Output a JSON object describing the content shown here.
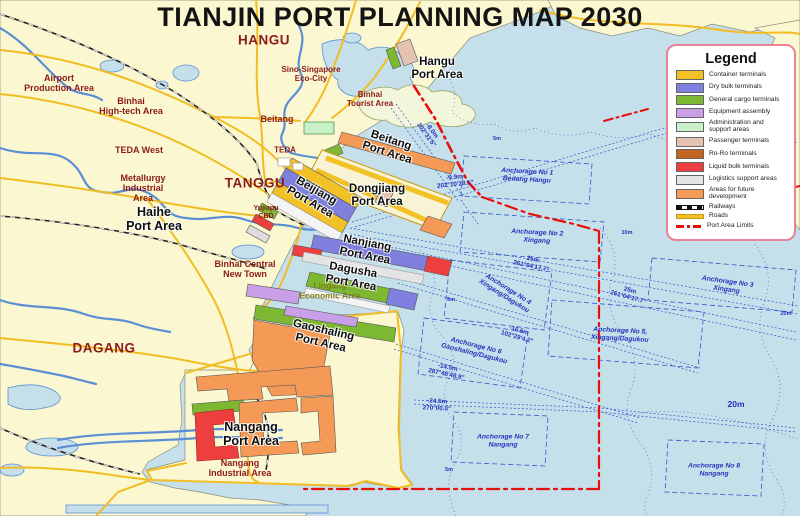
{
  "title": "TIANJIN PORT PLANNING MAP 2030",
  "colors": {
    "sea": "#c5dfeb",
    "land": "#fbf7d0",
    "road": "#f2bd24",
    "river": "#5b8fd4",
    "railway": "#222222",
    "port_limit": "#e8100a",
    "place_label": "#8b1b1b",
    "sea_label": "#2233bb",
    "container": "#f2c125",
    "dry_bulk": "#7f7fdd",
    "general_cargo": "#7cb832",
    "equipment": "#c9a0e8",
    "admin": "#c9f0c9",
    "passenger": "#e5c3b2",
    "roro": "#c3641f",
    "liquid": "#ee3f3f",
    "logistics": "#e4e4e4",
    "future": "#f59a56"
  },
  "legend": {
    "title": "Legend",
    "items": [
      {
        "key": "container",
        "label": "Container terminals",
        "type": "swatch",
        "color": "#f2c125"
      },
      {
        "key": "dry-bulk",
        "label": "Dry bulk terminals",
        "type": "swatch",
        "color": "#7f7fdd"
      },
      {
        "key": "general-cargo",
        "label": "General cargo terminals",
        "type": "swatch",
        "color": "#7cb832"
      },
      {
        "key": "equipment",
        "label": "Equipment assembly",
        "type": "swatch",
        "color": "#c9a0e8"
      },
      {
        "key": "admin",
        "label": "Administration and support areas",
        "type": "swatch",
        "color": "#c9f0c9"
      },
      {
        "key": "passenger",
        "label": "Passenger terminals",
        "type": "swatch",
        "color": "#e5c3b2"
      },
      {
        "key": "roro",
        "label": "Ro-Ro terminals",
        "type": "swatch",
        "color": "#c3641f"
      },
      {
        "key": "liquid",
        "label": "Liquid bulk terminals",
        "type": "swatch",
        "color": "#ee3f3f"
      },
      {
        "key": "logistics",
        "label": "Logistics support areas",
        "type": "swatch",
        "color": "#e4e4e4"
      },
      {
        "key": "future",
        "label": "Areas for future development",
        "type": "swatch",
        "color": "#f59a56"
      },
      {
        "key": "railways",
        "label": "Railways",
        "type": "railway"
      },
      {
        "key": "roads",
        "label": "Roads",
        "type": "road"
      },
      {
        "key": "limits",
        "label": "Port Area Limits",
        "type": "limit"
      }
    ]
  },
  "map_labels": [
    {
      "id": "label-hangu-city",
      "cls": "place-lg",
      "x": 264,
      "y": 40,
      "rot": 0,
      "lines": [
        "HANGU"
      ]
    },
    {
      "id": "label-tanggu",
      "cls": "place-lg",
      "x": 255,
      "y": 183,
      "rot": 0,
      "lines": [
        "TANGGU"
      ]
    },
    {
      "id": "label-dagang",
      "cls": "place-lg",
      "x": 104,
      "y": 348,
      "rot": 0,
      "lines": [
        "DAGANG"
      ]
    },
    {
      "id": "label-airport-production-area",
      "cls": "place",
      "x": 59,
      "y": 83,
      "rot": 0,
      "lines": [
        "Airport",
        "Production Area"
      ]
    },
    {
      "id": "label-binhai-hightech-area",
      "cls": "place",
      "x": 131,
      "y": 106,
      "rot": 0,
      "lines": [
        "Binhai",
        "High-tech Area"
      ]
    },
    {
      "id": "label-teda-west",
      "cls": "place",
      "x": 139,
      "y": 150,
      "rot": 0,
      "lines": [
        "TEDA West"
      ]
    },
    {
      "id": "label-metallurgy-industrial-area",
      "cls": "place",
      "x": 143,
      "y": 188,
      "rot": 0,
      "lines": [
        "Metallurgy",
        "Industrial",
        "Area"
      ]
    },
    {
      "id": "label-beitang-town",
      "cls": "place",
      "x": 277,
      "y": 119,
      "rot": 0,
      "lines": [
        "Beitang"
      ]
    },
    {
      "id": "label-teda",
      "cls": "place-sm",
      "x": 285,
      "y": 151,
      "rot": 0,
      "lines": [
        "TEDA"
      ]
    },
    {
      "id": "label-sino-singapore-eco-city",
      "cls": "place-sm",
      "x": 311,
      "y": 75,
      "rot": 0,
      "lines": [
        "Sino-Singapore",
        "Eco-City"
      ]
    },
    {
      "id": "label-binhai-tourist-area",
      "cls": "place-sm",
      "x": 370,
      "y": 100,
      "rot": 0,
      "lines": [
        "Binhai",
        "Tourist Area"
      ]
    },
    {
      "id": "label-yujiapu-cbd",
      "cls": "place-xs",
      "x": 266,
      "y": 213,
      "rot": 0,
      "lines": [
        "Yujiapu",
        "CBD"
      ]
    },
    {
      "id": "label-binhai-central-new-town",
      "cls": "place",
      "x": 245,
      "y": 269,
      "rot": 0,
      "lines": [
        "Binhai Central",
        "New Town"
      ]
    },
    {
      "id": "label-nangang-industrial-area",
      "cls": "place",
      "x": 240,
      "y": 468,
      "rot": 0,
      "lines": [
        "Nangang",
        "Industrial Area"
      ]
    },
    {
      "id": "label-lingang-economic-area",
      "cls": "olive",
      "x": 330,
      "y": 291,
      "rot": 0,
      "lines": [
        "Lingang",
        "Economic Area"
      ]
    },
    {
      "id": "label-haihe-port-area",
      "cls": "port-lg",
      "x": 154,
      "y": 219,
      "rot": 0,
      "lines": [
        "Haihe",
        "Port Area"
      ]
    },
    {
      "id": "label-hangu-port-area",
      "cls": "port",
      "x": 437,
      "y": 69,
      "rot": 0,
      "lines": [
        "Hangu",
        "Port Area"
      ]
    },
    {
      "id": "label-beitang-port-area",
      "cls": "port",
      "x": 389,
      "y": 147,
      "rot": 18,
      "lines": [
        "Beitang",
        "Port Area"
      ]
    },
    {
      "id": "label-dongjiang-port-area",
      "cls": "port",
      "x": 377,
      "y": 196,
      "rot": 0,
      "lines": [
        "Dongjiang",
        "Port Area"
      ]
    },
    {
      "id": "label-beijiang-port-area",
      "cls": "port",
      "x": 313,
      "y": 197,
      "rot": 30,
      "lines": [
        "Beijiang",
        "Port Area"
      ]
    },
    {
      "id": "label-nanjiang-port-area",
      "cls": "port",
      "x": 366,
      "y": 250,
      "rot": 11,
      "lines": [
        "Nanjiang",
        "Port Area"
      ]
    },
    {
      "id": "label-dagusha-port-area",
      "cls": "port",
      "x": 352,
      "y": 277,
      "rot": 10,
      "lines": [
        "Dagusha",
        "Port Area"
      ]
    },
    {
      "id": "label-gaoshaling-port-area",
      "cls": "port",
      "x": 322,
      "y": 337,
      "rot": 13,
      "lines": [
        "Gaoshaling",
        "Port Area"
      ]
    },
    {
      "id": "label-nangang-port-area",
      "cls": "port-lg",
      "x": 251,
      "y": 434,
      "rot": 0,
      "lines": [
        "Nangang",
        "Port Area"
      ]
    },
    {
      "id": "label-anchorage-1",
      "cls": "sea",
      "x": 527,
      "y": 176,
      "rot": 3,
      "lines": [
        "Anchorage No 1",
        "Beitang Hangu"
      ]
    },
    {
      "id": "label-anchorage-2",
      "cls": "sea",
      "x": 537,
      "y": 237,
      "rot": 3,
      "lines": [
        "Anchorage No 2",
        "Xingang"
      ]
    },
    {
      "id": "label-anchorage-3",
      "cls": "sea",
      "x": 727,
      "y": 286,
      "rot": 8,
      "lines": [
        "Anchorage No 3",
        "Xingang"
      ]
    },
    {
      "id": "label-anchorage-4",
      "cls": "sea",
      "x": 506,
      "y": 293,
      "rot": 32,
      "lines": [
        "Anchorage No 4",
        "Xingang/Dagukou"
      ]
    },
    {
      "id": "label-anchorage-5",
      "cls": "sea",
      "x": 620,
      "y": 335,
      "rot": 3,
      "lines": [
        "Anchorage No 5,",
        "Xingang/Dagukou"
      ]
    },
    {
      "id": "label-anchorage-6",
      "cls": "sea",
      "x": 475,
      "y": 350,
      "rot": 14,
      "lines": [
        "Anchorage No 6",
        "Gaoshaling/Dagukou"
      ]
    },
    {
      "id": "label-anchorage-7",
      "cls": "sea",
      "x": 503,
      "y": 441,
      "rot": 0,
      "lines": [
        "Anchorage No 7",
        "Nangang"
      ]
    },
    {
      "id": "label-anchorage-8",
      "cls": "sea",
      "x": 714,
      "y": 470,
      "rot": 0,
      "lines": [
        "Anchorage No 8",
        "Nangang"
      ]
    },
    {
      "id": "label-depth-9-9m",
      "cls": "depth",
      "x": 455,
      "y": 181,
      "rot": -6,
      "lines": [
        "-9.9m",
        "202°10'28.1\""
      ]
    },
    {
      "id": "label-depth-25m-a",
      "cls": "depth",
      "x": 532,
      "y": 263,
      "rot": 12,
      "lines": [
        "25m",
        "261°04'17.7\""
      ]
    },
    {
      "id": "label-depth-25m-b",
      "cls": "depth",
      "x": 629,
      "y": 294,
      "rot": 15,
      "lines": [
        "25m",
        "261°04'17.7\""
      ]
    },
    {
      "id": "label-depth-16-5m",
      "cls": "depth",
      "x": 518,
      "y": 334,
      "rot": 16,
      "lines": [
        "-16.5m",
        "102°29'4.2\""
      ]
    },
    {
      "id": "label-depth-14-5m",
      "cls": "depth",
      "x": 447,
      "y": 371,
      "rot": 12,
      "lines": [
        "-14.5m",
        "287°48'48.9\""
      ]
    },
    {
      "id": "label-depth-24-5m",
      "cls": "depth",
      "x": 437,
      "y": 405,
      "rot": 3,
      "lines": [
        "-24.5m",
        "270°00.0\""
      ]
    },
    {
      "id": "label-depth-hangu-channel",
      "cls": "depth",
      "x": 429,
      "y": 133,
      "rot": 54,
      "lines": [
        "-8.0m",
        "202°31'5\""
      ]
    },
    {
      "id": "label-depth-20m",
      "cls": "depth-lg",
      "x": 736,
      "y": 405,
      "rot": 0,
      "lines": [
        "20m"
      ]
    },
    {
      "id": "label-contour-5m-a",
      "cls": "contour",
      "x": 497,
      "y": 139,
      "rot": 0,
      "lines": [
        "5m"
      ]
    },
    {
      "id": "label-contour-5m-b",
      "cls": "contour",
      "x": 451,
      "y": 300,
      "rot": 0,
      "lines": [
        "5m"
      ]
    },
    {
      "id": "label-contour-5m-c",
      "cls": "contour",
      "x": 449,
      "y": 470,
      "rot": 0,
      "lines": [
        "5m"
      ]
    },
    {
      "id": "label-contour-10m",
      "cls": "contour",
      "x": 627,
      "y": 233,
      "rot": 0,
      "lines": [
        "10m"
      ]
    },
    {
      "id": "label-contour-20m",
      "cls": "contour",
      "x": 786,
      "y": 314,
      "rot": 0,
      "lines": [
        "20m"
      ]
    }
  ]
}
